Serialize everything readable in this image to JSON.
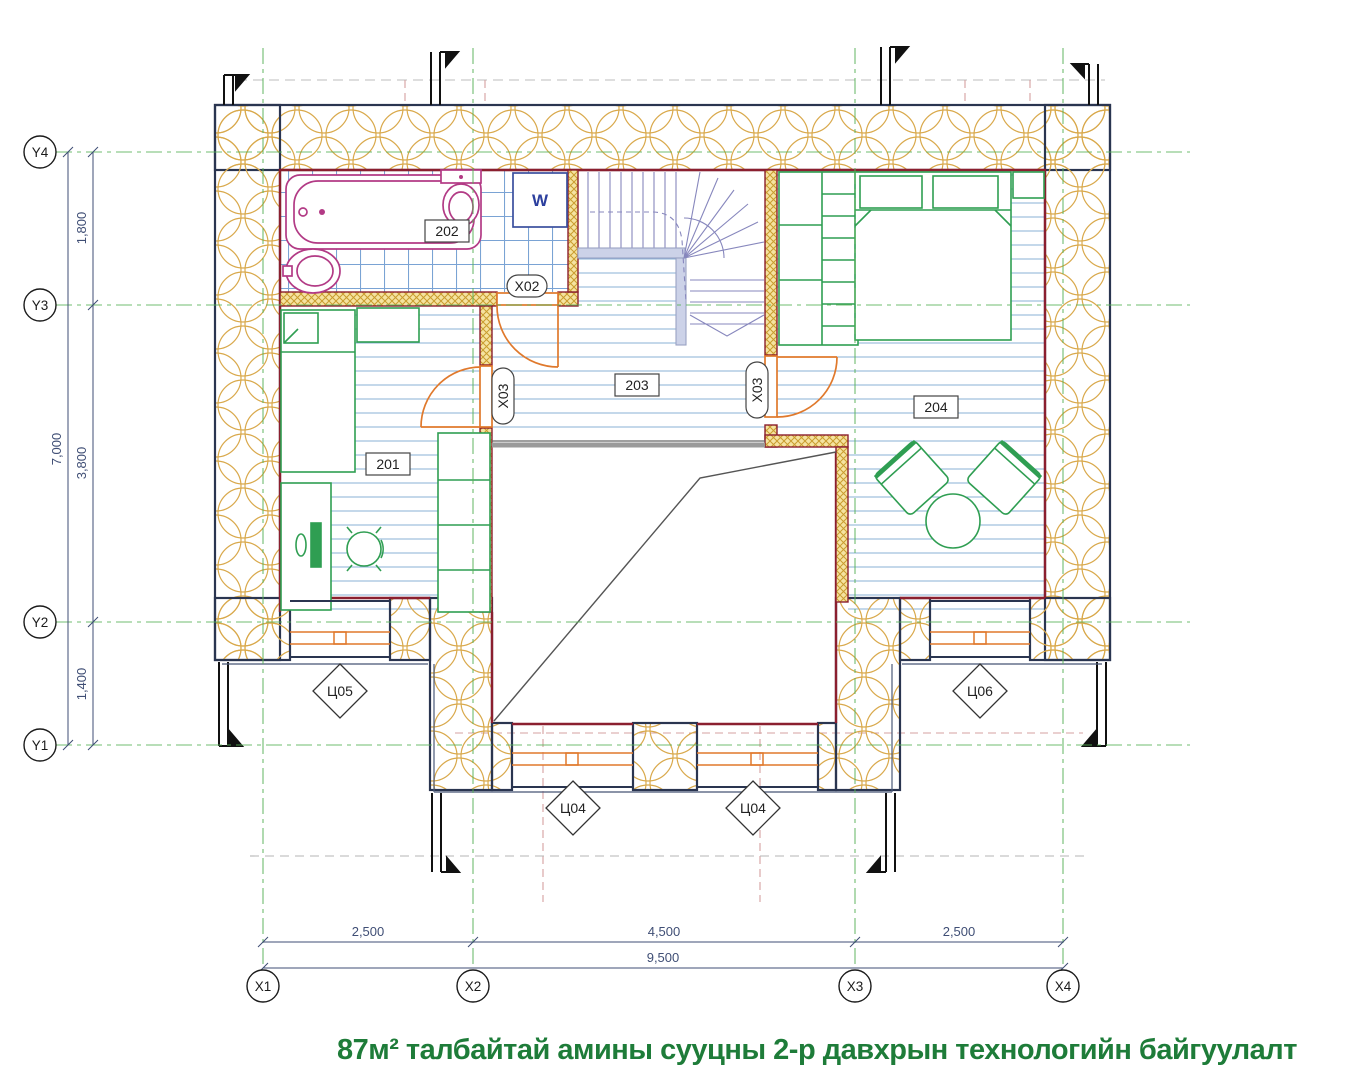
{
  "title": "87м² талбайтай амины сууцны 2-р давхрын технологийн байгуулалт",
  "grid": {
    "y_bubbles": [
      "Y4",
      "Y3",
      "Y2",
      "Y1"
    ],
    "x_bubbles": [
      "X1",
      "X2",
      "X3",
      "X4"
    ]
  },
  "dimensions": {
    "left": {
      "segments": [
        "1,800",
        "3,800",
        "1,400"
      ],
      "total": "7,000"
    },
    "bottom": {
      "segments": [
        "2,500",
        "4,500",
        "2,500"
      ],
      "total": "9,500"
    }
  },
  "room_labels": {
    "bedroom_left": "201",
    "bathroom": "202",
    "hall": "203",
    "bedroom_right": "204"
  },
  "door_labels": {
    "bathroom": "X02",
    "bedroom_left": "X03",
    "bedroom_right": "X03"
  },
  "window_labels": {
    "left": "Ц05",
    "center_left": "Ц04",
    "center_right": "Ц04",
    "right": "Ц06"
  },
  "appliance_labels": {
    "washer": "W"
  },
  "colors": {
    "title_green": "#1e7c39",
    "furniture_green": "#2f9e52",
    "sanitary_magenta": "#b23a85",
    "door_orange": "#e0792c",
    "gridline_green": "#57b157",
    "wall_navy": "#2a3550",
    "inner_wall_maroon": "#8b1f2f",
    "insulation_tan": "#d9a94c",
    "floor_line_blue": "#8ab1d6",
    "stair_slate": "#8787bd",
    "dimension_navy": "#3f4e75"
  }
}
